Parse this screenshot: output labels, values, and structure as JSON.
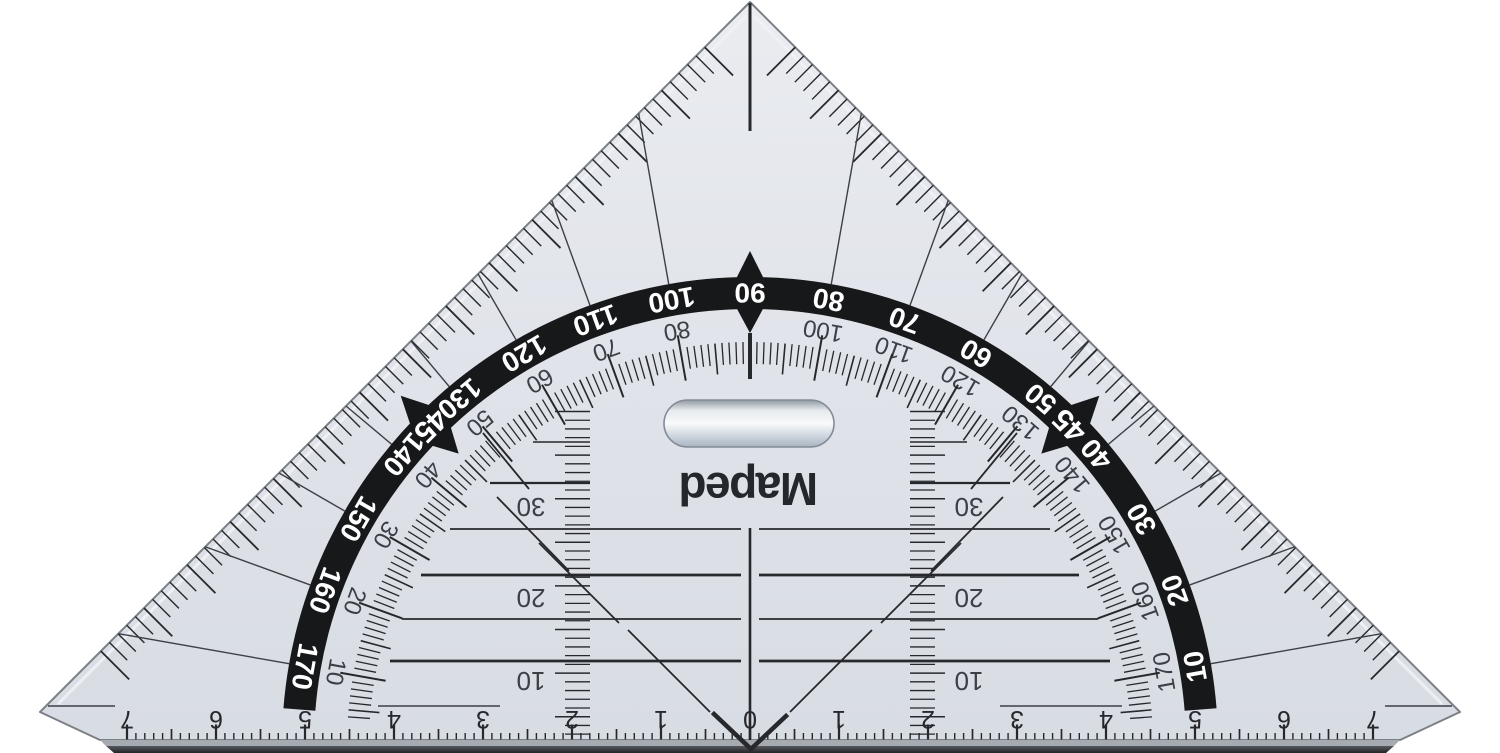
{
  "brand": {
    "logo_text": "Maped"
  },
  "protractor": {
    "outer_scale": {
      "angles": [
        10,
        20,
        30,
        40,
        50,
        60,
        70,
        80,
        90,
        100,
        110,
        120,
        130,
        140,
        150,
        160,
        170
      ],
      "labels": [
        "10",
        "20",
        "30",
        "40",
        "50",
        "60",
        "70",
        "80",
        "90",
        "100",
        "110",
        "120",
        "130",
        "140",
        "150",
        "160",
        "170"
      ]
    },
    "bold_marks": {
      "angles": [
        45,
        135
      ],
      "label": "45"
    },
    "inner_scale": {
      "angles": [
        10,
        20,
        30,
        40,
        50,
        60,
        70,
        80,
        100,
        110,
        120,
        130,
        140,
        150,
        160,
        170
      ],
      "labels": [
        "170",
        "160",
        "150",
        "140",
        "130",
        "120",
        "110",
        "100",
        "80",
        "70",
        "60",
        "50",
        "40",
        "30",
        "20",
        "10"
      ]
    }
  },
  "parallel_ruler": {
    "labels": [
      {
        "text": "30",
        "y": 507
      },
      {
        "text": "20",
        "y": 598
      },
      {
        "text": "10",
        "y": 681
      }
    ]
  },
  "bottom_ruler": {
    "numbers": [
      "0",
      "1",
      "2",
      "3",
      "4",
      "5",
      "6",
      "7"
    ]
  },
  "colors": {
    "background": "#ffffff",
    "body_top": "#eaecf0",
    "body_mid": "#e1e4ea",
    "body_bottom": "#d8dce3",
    "band": "#17181a",
    "band_text": "#ffffff",
    "ink": "#26282c",
    "muted_ink": "#3c3f45",
    "edge": "#7b8087",
    "edge_highlight": "#f0f2f6",
    "strip_light": "#a6abb2",
    "strip_dark_top": "#55585d",
    "strip_dark_bottom": "#232427",
    "handle_top": "#8f98a2",
    "handle_center": "#f8fafb",
    "handle_bottom": "#a9b4c0",
    "handle_stroke": "#828c97"
  }
}
